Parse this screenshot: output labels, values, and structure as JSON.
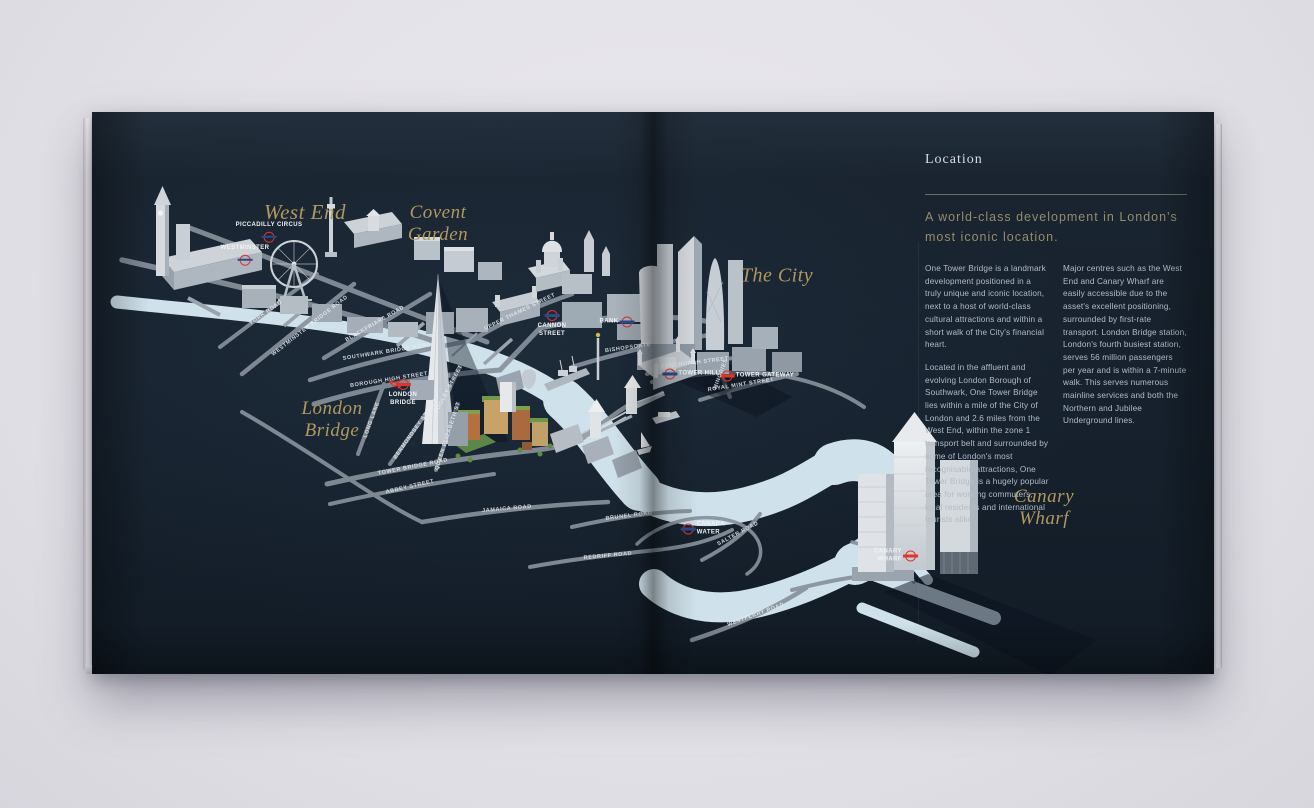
{
  "colors": {
    "page_navy": "#16212d",
    "river_blue": "#cfe1ea",
    "road_grey": "#87919c",
    "accent_gold": "#b0985f",
    "roundel_red": "#dd352c",
    "roundel_bar_blue": "#2c4a8a",
    "body_text": "#b3bcc6",
    "backdrop": "#e3e2e8"
  },
  "map": {
    "districts": [
      {
        "label": "West End"
      },
      {
        "label": "Covent\nGarden"
      },
      {
        "label": "The City"
      },
      {
        "label": "London\nBridge"
      },
      {
        "label": "Canary\nWharf"
      }
    ],
    "stations": [
      {
        "label": "PICCADILLY CIRCUS"
      },
      {
        "label": "WESTMINSTER"
      },
      {
        "label": "CANNON\nSTREET"
      },
      {
        "label": "BANK"
      },
      {
        "label": "TOWER HILL"
      },
      {
        "label": "TOWER GATEWAY"
      },
      {
        "label": "LONDON\nBRIDGE"
      },
      {
        "label": "CANADA\nWATER"
      },
      {
        "label": "CANARY\nWHARF"
      }
    ],
    "roads": [
      {
        "label": "YORK ROAD"
      },
      {
        "label": "WESTMINSTER BRIDGE ROAD"
      },
      {
        "label": "BLACKFRIARS ROAD"
      },
      {
        "label": "SOUTHWARK BRIDGE ROAD"
      },
      {
        "label": "BOROUGH HIGH STREET"
      },
      {
        "label": "UPPER THAMES STREET"
      },
      {
        "label": "BISHOPSGATE"
      },
      {
        "label": "FENCHURCH STREET"
      },
      {
        "label": "ROYAL MINT STREET"
      },
      {
        "label": "MINORIES"
      },
      {
        "label": "LONG LANE"
      },
      {
        "label": "BERMONDSEY STREET"
      },
      {
        "label": "TOOLEY STREET"
      },
      {
        "label": "QUEEN ELIZABETH ST"
      },
      {
        "label": "TOWER BRIDGE ROAD"
      },
      {
        "label": "ABBEY STREET"
      },
      {
        "label": "JAMAICA ROAD"
      },
      {
        "label": "BRUNEL ROAD"
      },
      {
        "label": "REDRIFF ROAD"
      },
      {
        "label": "SALTER ROAD"
      },
      {
        "label": "WESTFERRY ROAD"
      }
    ]
  },
  "location_panel": {
    "header": "Location",
    "headline": "A world-class development in London's most iconic location.",
    "col1_para1": "One Tower Bridge is a landmark development positioned in a truly unique and iconic location, next to a host of world-class cultural attractions and within a short walk of the City's financial heart.",
    "col1_para2": "Located in the affluent and evolving London Borough of Southwark, One Tower Bridge lies within a mile of the City of London and 2.6 miles from the West End, within the zone 1 transport belt and surrounded by some of London's most recognisable attractions, One Tower Bridge is a hugely popular area for working commuters, local residents and international tourists alike.",
    "col2_para1": "Major centres such as the West End and Canary Wharf are easily accessible due to the asset's excellent positioning, surrounded by first-rate transport. London Bridge station, London's fourth busiest station, serves 56 million passengers per year and is within a 7-minute walk. This serves numerous mainline services and both the Northern and Jubilee Underground lines."
  }
}
